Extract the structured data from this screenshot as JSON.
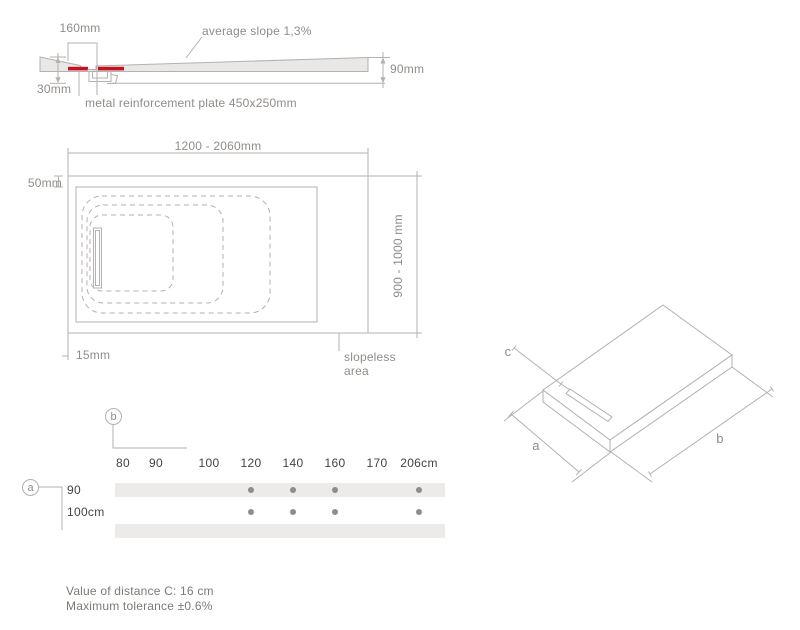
{
  "colors": {
    "accent_red": "#c8111e",
    "line_grey": "#b4b1ae",
    "text_grey": "#908c88",
    "text_dark": "#454341",
    "band_grey": "#ecebe9",
    "dot_grey": "#8f8d8b",
    "slab_fill": "#e9e8e6",
    "note_grey": "#7e7a76"
  },
  "cross_section": {
    "dim_drain_zone": "160mm",
    "slope_label": "average slope 1,3%",
    "dim_height": "90mm",
    "dim_thickness": "30mm",
    "plate_label": "metal reinforcement plate 450x250mm"
  },
  "plan_view": {
    "dim_length_range": "1200 - 2060mm",
    "dim_border": "50mm",
    "dim_width_range": "900 - 1000 mm",
    "dim_drain_offset": "15mm",
    "slopeless_line1": "slopeless",
    "slopeless_line2": "area"
  },
  "iso_view": {
    "dim_a": "a",
    "dim_b": "b",
    "dim_c": "c"
  },
  "chart_data": {
    "type": "table",
    "col_axis_label": "b",
    "row_axis_label": "a",
    "columns": [
      "80",
      "90",
      "100",
      "120",
      "140",
      "160",
      "170",
      "206cm"
    ],
    "rows": [
      {
        "label": "90",
        "available": [
          false,
          false,
          false,
          true,
          true,
          true,
          false,
          true
        ]
      },
      {
        "label": "100cm",
        "available": [
          false,
          false,
          false,
          true,
          true,
          true,
          false,
          true
        ]
      }
    ]
  },
  "notes": {
    "line1": "Value of distance C: 16 cm",
    "line2": "Maximum tolerance ±0.6%"
  }
}
